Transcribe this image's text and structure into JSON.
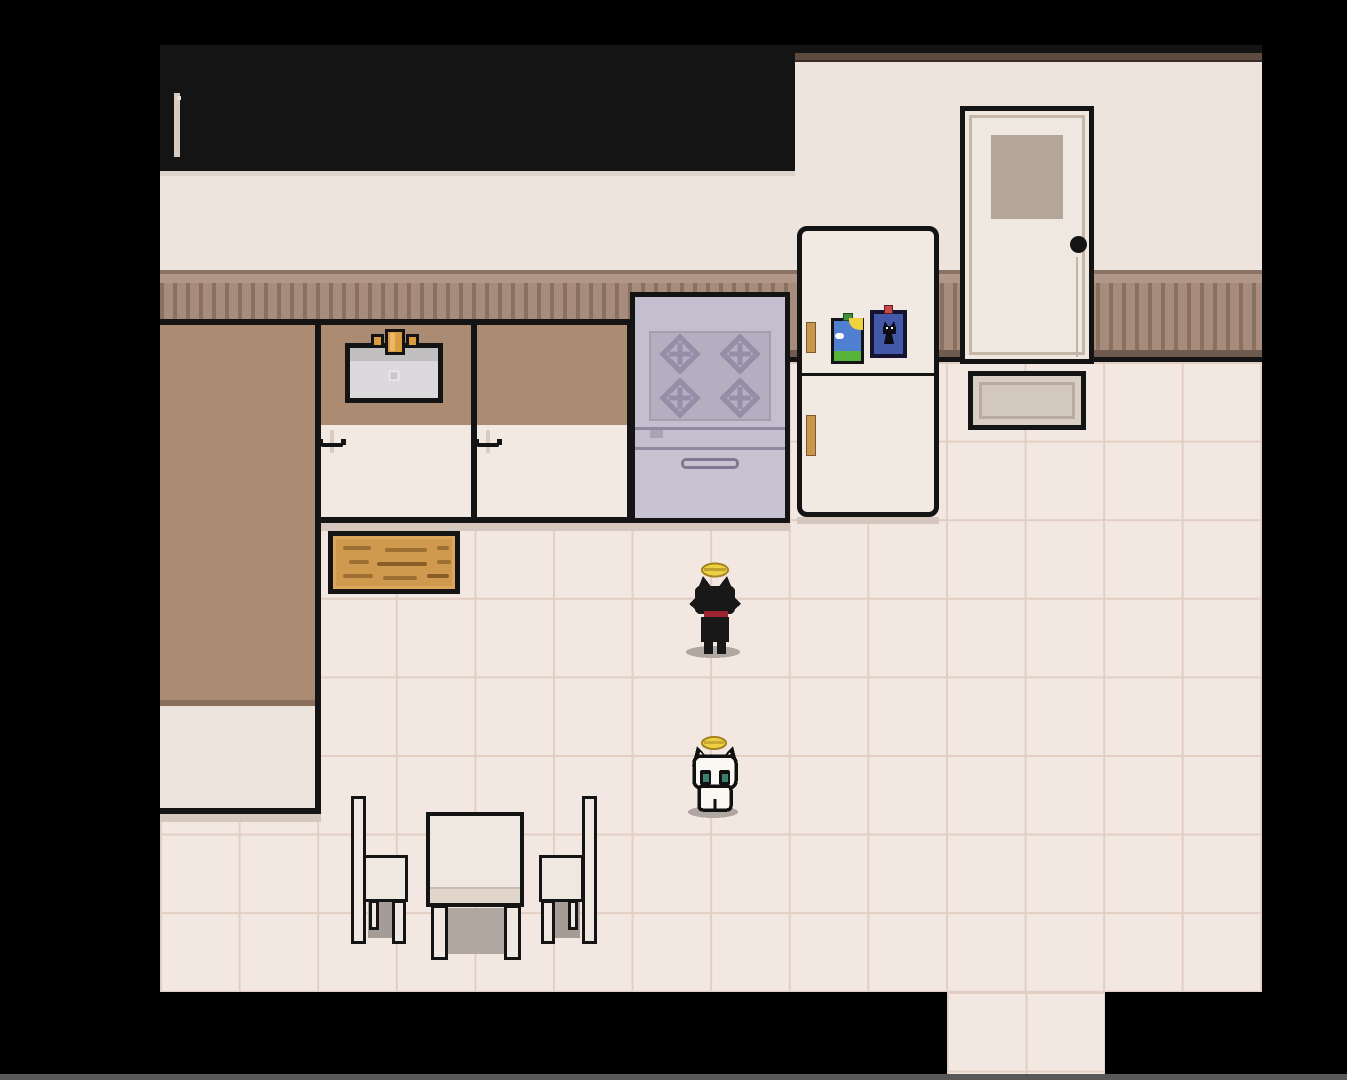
{
  "meta": {
    "domain": "Game",
    "scene_type": "pixel-art top-down kitchen room",
    "visible_text": ""
  },
  "palette": {
    "bg": "#000000",
    "screen_line": "#585858",
    "outline": "#141414",
    "wall": "#ece4dd",
    "molding": "#5d4a41",
    "wainscot_rail_top": "#8a7365",
    "wainscot_rail_light": "#b29687",
    "wainscot_base": "#a78c7c",
    "wainscot_slat": "#8a7060",
    "wainscot_rail_bottom": "#6e5a4e",
    "floor_tile": "#f2e8e1",
    "floor_grout": "#e3cec4",
    "cabinet_body": "#f1e9e2",
    "cabinet_top": "#ddd2c9",
    "cabinet_trim": "#d8cabe",
    "cabinet_panel": "#f3ece5",
    "counter_top": "#ab8c73",
    "counter_edge": "#8a6f5a",
    "counter_front": "#ece4dd",
    "drawer_face": "#f3ede6",
    "drawer_trim": "#d8ccc2",
    "sink_rim_dark": "#c2bfc0",
    "sink_body": "#dcd9dc",
    "faucet_gold": "#d99c3f",
    "faucet_gold_light": "#e9b868",
    "stove_body": "#c3bfcf",
    "stove_panel": "#b3afc1",
    "stove_burner": "#948fa6",
    "stove_detail": "#8f8aa0",
    "oven_door": "#c7c3d3",
    "fridge_body": "#f0eae3",
    "fridge_handle": "#c9964e",
    "magnet_sky": "#4f7fd0",
    "magnet_sun": "#efd23c",
    "magnet_grass": "#57b33a",
    "magnet_cloud": "#ffffff",
    "magnet_green_tab": "#3f8f3f",
    "magnet2_bg": "#4458aa",
    "magnet2_border": "#141430",
    "magnet2_red": "#c74848",
    "door_body": "#efe8e1",
    "door_trim": "#c6b7a9",
    "window_frame": "#b3a699",
    "window_glass": "#9cafbc",
    "window_glass_light": "#b7c3cb",
    "mat_outer": "#d9cfc5",
    "mat_inner": "#d3c8be",
    "mat_trim": "#b9ab9e",
    "board_wood": "#cf9a4e",
    "board_wood_light": "#dca75b",
    "board_grain": "#9e6f33",
    "furniture_cream": "#efe8e1",
    "table_front": "#e0d5cb",
    "shadow": "#b1a7a1",
    "halo": "#ecd044",
    "halo_dark": "#a5821e",
    "cat_black": "#181818",
    "collar_red": "#9b2531",
    "cat_white": "#fbf8f4",
    "cat_eye": "#3f7f6f"
  },
  "scene": {
    "room": "kitchen",
    "upper_cabinets": {
      "count": 4,
      "doors_per_cabinet": 2
    },
    "sink_unit": {
      "drawers": 3,
      "has_sink": true,
      "has_faucet": true
    },
    "drawer_unit": {
      "drawers": 3
    },
    "stove": {
      "burners": 4,
      "knobs": 5,
      "has_oven_handle": true
    },
    "refrigerator": {
      "handles": 2,
      "magnets": [
        "landscape-photo-magnet",
        "black-cat-photo-magnet"
      ],
      "doors": 2
    },
    "door": {
      "window_panes": 4,
      "knob": "black-round-knob"
    },
    "doormat": {
      "present": true
    },
    "cutting_board": {
      "material": "wood"
    },
    "dining_table": {
      "chairs": 2
    },
    "characters": [
      {
        "name": "black-cat",
        "accessory": "gold-halo",
        "collar": "red",
        "facing": "up"
      },
      {
        "name": "white-cat",
        "accessory": "gold-halo",
        "eyes": "teal",
        "facing": "down"
      }
    ]
  }
}
